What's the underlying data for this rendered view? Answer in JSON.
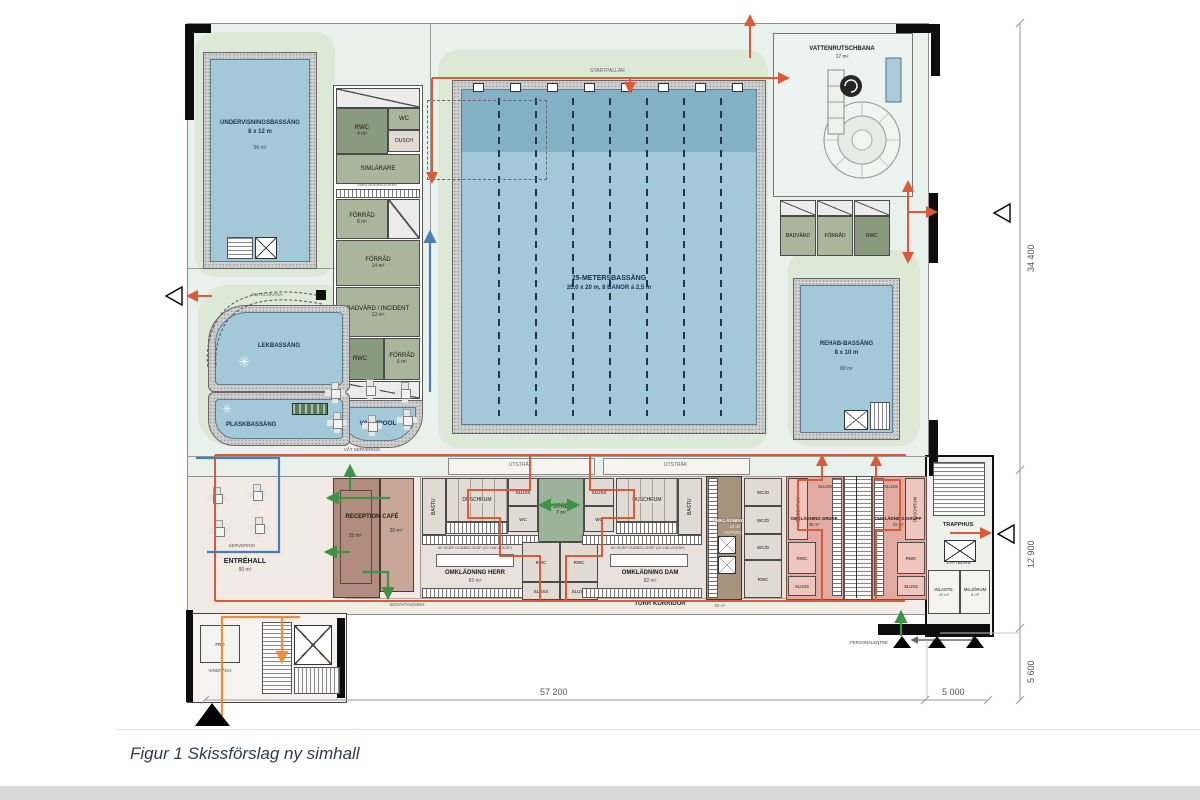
{
  "caption": "Figur 1 Skissförslag ny simhall",
  "dimensions": {
    "height_hall": "34 400",
    "height_entry": "12 900",
    "height_annex": "5 600",
    "width_main": "57 200",
    "width_annex": "5 000"
  },
  "pool_hall": {
    "teaching_pool": {
      "title": "UNDERVISNINGSBASSÄNG",
      "size": "8 x 12 m",
      "area": "96 m²"
    },
    "main_pool": {
      "title": "25-METERSBASSÄNG",
      "spec": "25,0 x 20 m, 8 BANOR á 2,5 m",
      "start_blocks": "STARTPALLAR"
    },
    "warm_pool": {
      "title": "VARMPOOL"
    },
    "play_pool": {
      "title": "LEKBASSÄNG"
    },
    "splash_pool": {
      "title": "PLASKBASSÄNG",
      "mini_slide": "MINI-RUTSCHKANA"
    },
    "slide_label": "RUTSCHKANA",
    "rehab_pool": {
      "title": "REHAB-BASSÄNG",
      "size": "8 x 10 m",
      "area": "80 m²"
    },
    "water_slide": {
      "title": "VATTENRUTSCHBANA",
      "area": "17 m²"
    },
    "wet_serving": "VÅT SERVERING",
    "rooms_left": {
      "rwc1": {
        "label": "RWC",
        "area": "4 m²"
      },
      "wc": {
        "label": "WC",
        "area": "2 m²"
      },
      "dusch": {
        "label": "DUSCH"
      },
      "simlarare": {
        "label": "SIMLÄRARE"
      },
      "lockers_note": "OMKLÄDNINGSSKÅP",
      "forrad1": {
        "label": "FÖRRÅD",
        "area": "8 m²"
      },
      "forrad2": {
        "label": "FÖRRÅD",
        "area": "14 m²"
      },
      "badvard": {
        "label": "BADVÄRD / INCIDENT",
        "area": "13 m²"
      },
      "rwc2": {
        "label": "RWC"
      },
      "forrad3": {
        "label": "FÖRRÅD",
        "area": "6 m²"
      }
    },
    "rooms_right": {
      "badvard": "BADVÄRD",
      "forrad": "FÖRRÅD",
      "rwc": "RWC"
    }
  },
  "entry": {
    "hall": {
      "title": "ENTRÉHALL",
      "area": "90 m²"
    },
    "servering": "SERVERING",
    "reception": {
      "title": "RECEPTION CAFÉ",
      "area_reception": "35 m²",
      "area_cafe": "20 m²"
    },
    "vindfang": "VINDFÅNG",
    "frd": "FRD"
  },
  "changing": {
    "utstrak": "UTSTRÅK",
    "bastu": "BASTU",
    "duschrum": "DUSCHRUM",
    "stad": {
      "title": "STÄD",
      "area": "7 m²"
    },
    "sluss": "SLUSS",
    "wc": "WC",
    "rwc": "RWC",
    "wcd": "WC/D",
    "herr": {
      "title": "OMKLÄDNING HERR",
      "area": "82 m²",
      "lockers": "60 SKÅP DUBBELSKÅP (20 HALVSKÅP)"
    },
    "dam": {
      "title": "OMKLÄDNING DAM",
      "area": "82 m²",
      "lockers": "60 SKÅP DUBBELSKÅP (20 HALVSKÅP)"
    },
    "flex": {
      "title": "OMKLÄDNING FLEX",
      "area": "34 m²",
      "sub": "HCP/WC/D"
    },
    "grupp1": {
      "title": "OMKLÄDNING GRUPP",
      "area": "36 m²"
    },
    "grupp2": {
      "title": "OMKLÄDNING GRUPP",
      "area": "32 m²"
    },
    "torr_korridor": {
      "title": "TORR KORRIDOR",
      "area": "50 m²"
    },
    "skoavtagning": "SKOAVTAGNING"
  },
  "service": {
    "trapphus": "TRAPPHUS",
    "lyftbord": "LYFTBORD",
    "inlastning": {
      "title": "INLASTN.",
      "area": "20 m²"
    },
    "miljorum": {
      "title": "MILJÖRUM",
      "area": "8 m²"
    },
    "personalentre": "PERSONALENTRÉ"
  },
  "colors": {
    "flow_red": "#d85c3c",
    "flow_orange": "#e8923c",
    "flow_blue": "#4d7db5",
    "flow_green": "#3f9145",
    "water": "#a3c8d8",
    "water_deep": "#82b1c5",
    "room_sage": "#a9b69b",
    "room_dark_sage": "#8a9a7e",
    "reception_brown": "#b08d7e",
    "grupp_pink": "#e2aba1",
    "flex_brown": "#a8937d"
  }
}
